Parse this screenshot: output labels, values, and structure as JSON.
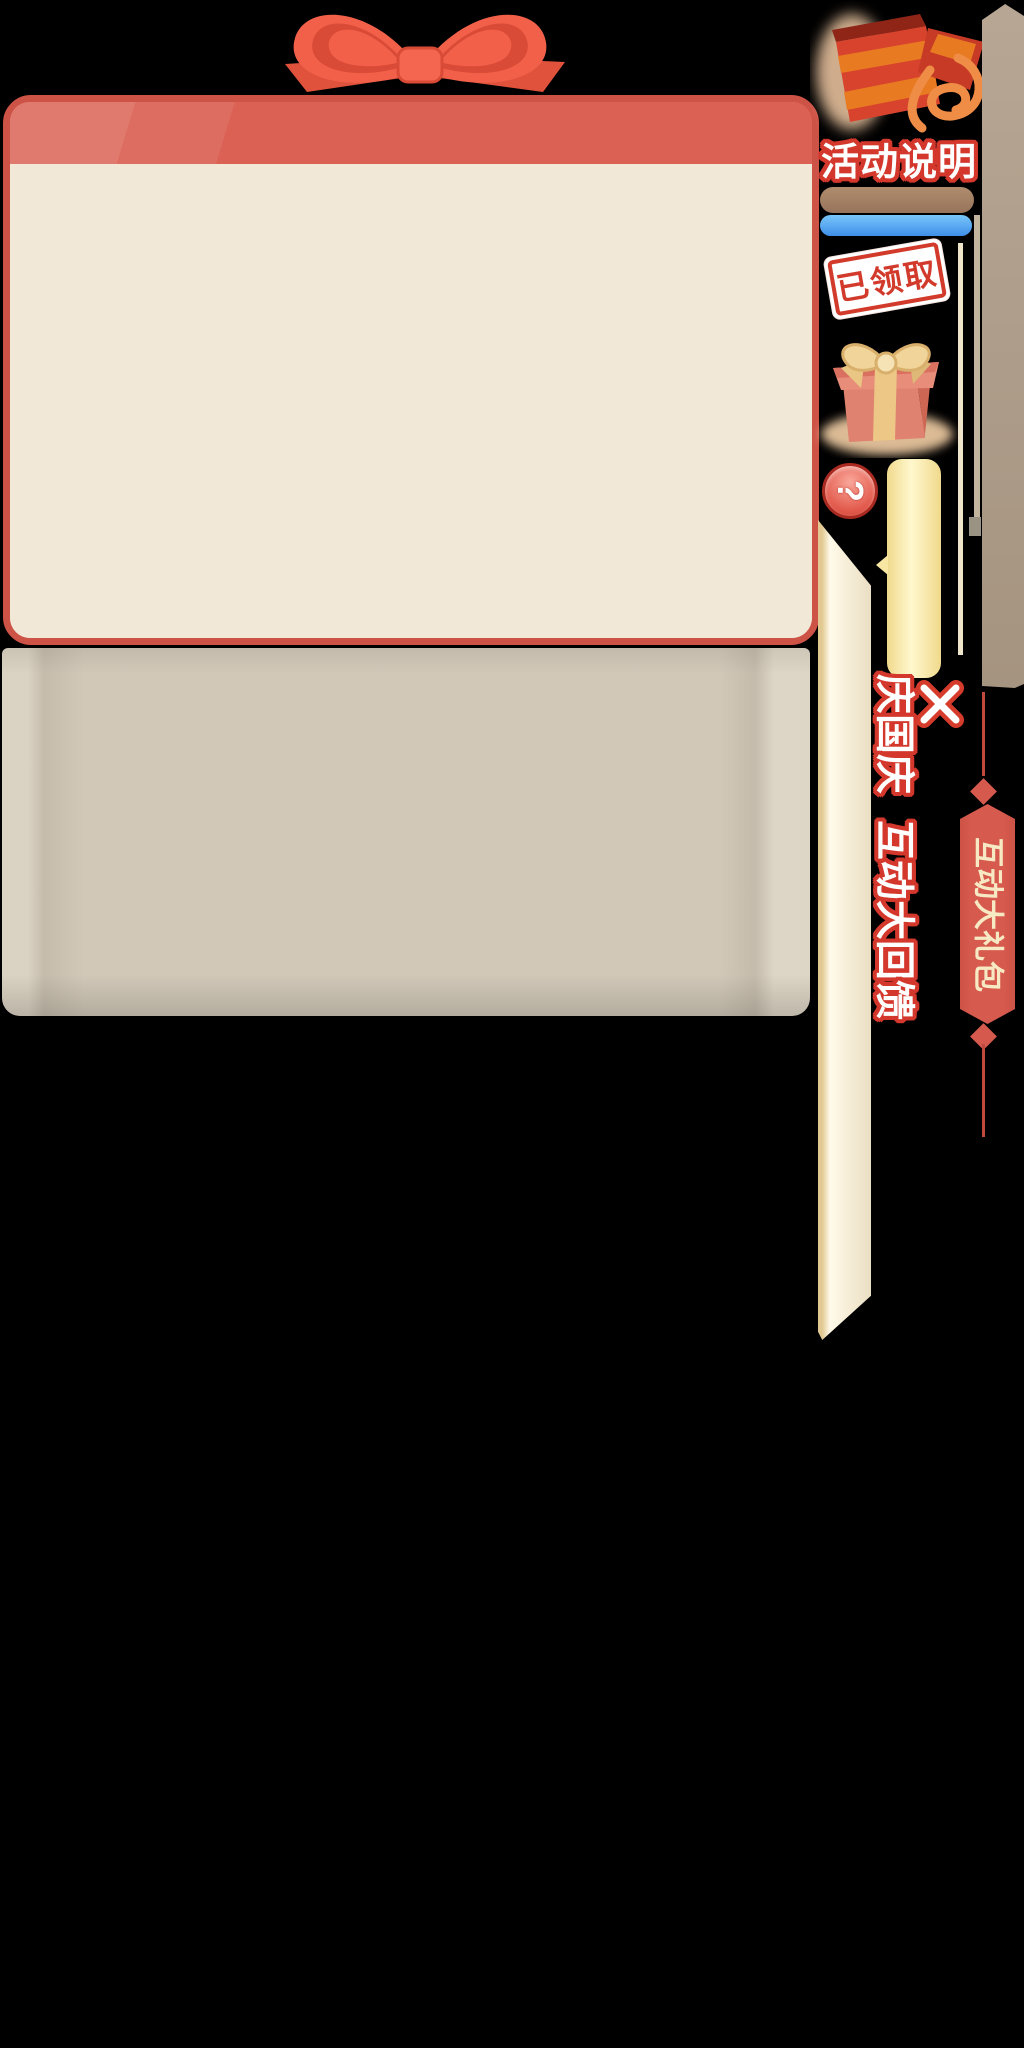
{
  "event": {
    "title_vertical": "庆国庆 互动大回馈",
    "ribbon_tab_label": "互动大礼包",
    "activity_button_label": "活动说明",
    "claimed_stamp_label": "已领取",
    "help_label": "?"
  },
  "colors": {
    "background": "#000000",
    "panel_border_red": "#CE5347",
    "panel_header_red": "#DA6153",
    "panel_body_cream": "#F1E8D8",
    "lower_panel_beige": "#D1C8B8",
    "bow_red": "#F2604A",
    "brown_bar": "#A38064",
    "blue_bar": "#4E9DEF",
    "stamp_red": "#D23B2B",
    "yellow_bar": "#FFF8CE",
    "ribbon_tab_red": "#D65A4D",
    "ribbon_text_cream": "#F7E9C4",
    "tan_bar": "#B1A08D",
    "text_outline_red": "#D4382C"
  }
}
